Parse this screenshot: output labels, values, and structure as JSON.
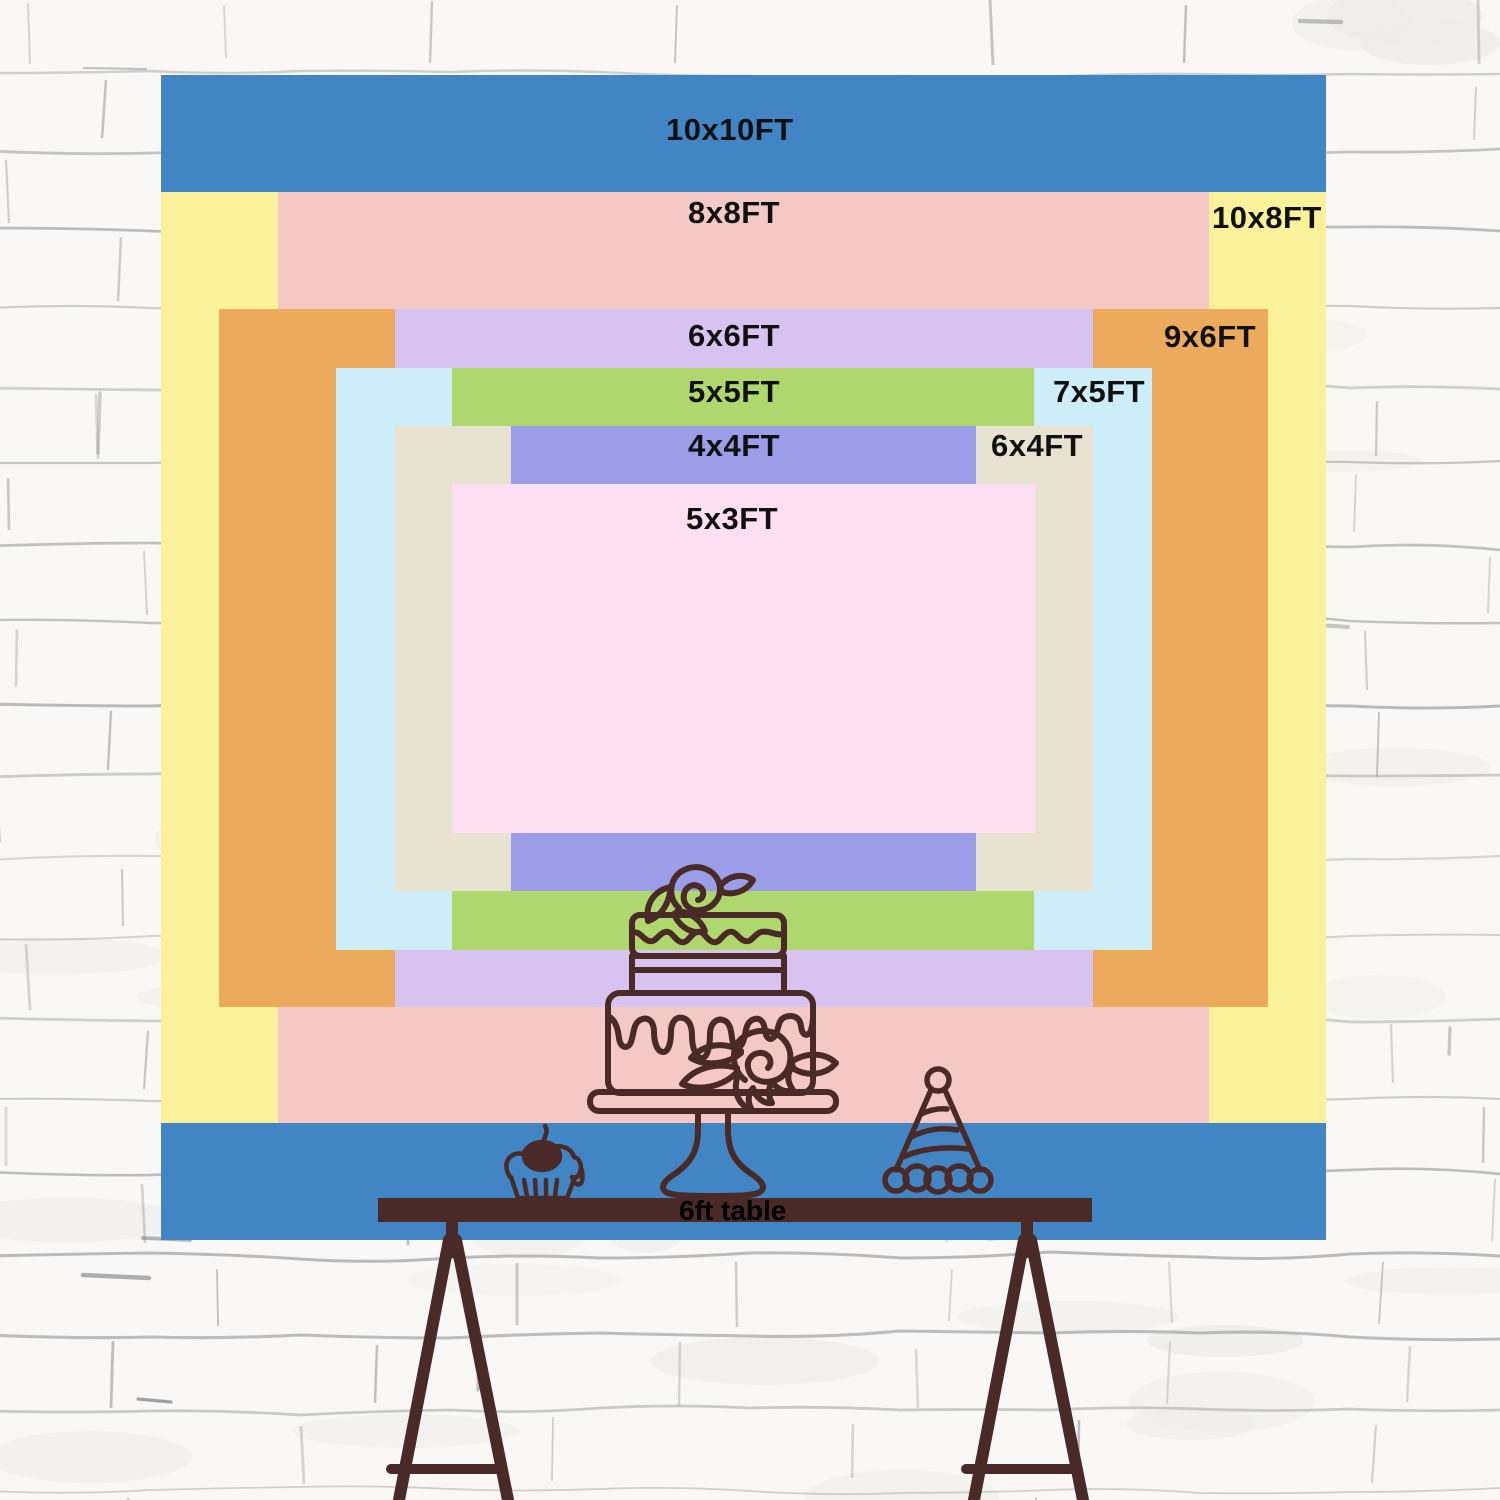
{
  "backdrop": {
    "sizes": [
      {
        "name": "10x10",
        "label": "10x10FT",
        "color": "#4285c4"
      },
      {
        "name": "10x8",
        "label": "10x8FT",
        "color": "#faf19b"
      },
      {
        "name": "8x8",
        "label": "8x8FT",
        "color": "#f3c8c5"
      },
      {
        "name": "9x6",
        "label": "9x6FT",
        "color": "#ebaa5c"
      },
      {
        "name": "6x6",
        "label": "6x6FT",
        "color": "#d8c2f0"
      },
      {
        "name": "7x5",
        "label": "7x5FT",
        "color": "#cdedf8"
      },
      {
        "name": "5x5",
        "label": "5x5FT",
        "color": "#aed86d"
      },
      {
        "name": "6x4",
        "label": "6x4FT",
        "color": "#e8e3d1"
      },
      {
        "name": "4x4",
        "label": "4x4FT",
        "color": "#9c9de8"
      },
      {
        "name": "5x3",
        "label": "5x3FT",
        "color": "#fcdff0"
      }
    ],
    "label_color": "#101010"
  },
  "table": {
    "label": "6ft table",
    "bar_color": "#4a2a26"
  },
  "artwork": {
    "line_color": "#4a2a26",
    "icons": [
      "cupcake-icon",
      "tiered-cake-icon",
      "party-hat-icon"
    ]
  },
  "wall": {
    "background": "#f9f8f6",
    "mortar_line_color": "#a2a5a7"
  }
}
